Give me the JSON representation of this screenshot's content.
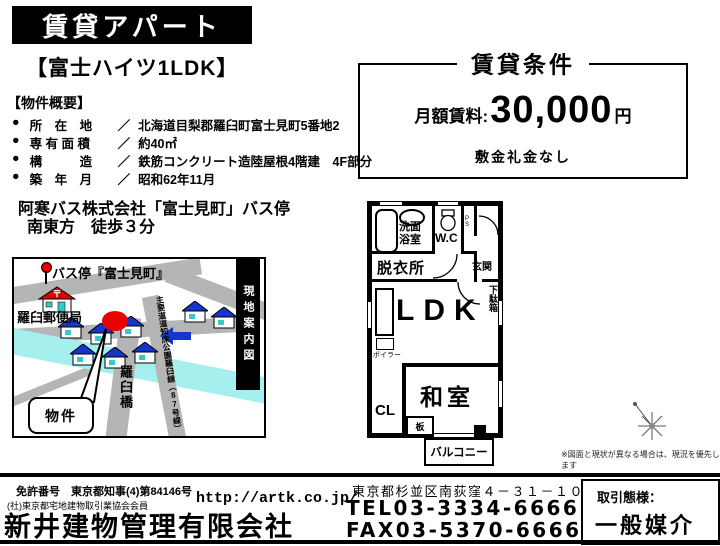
{
  "banner": {
    "title": "賃貸アパート"
  },
  "listing": {
    "name": "【富士ハイツ1LDK】",
    "overview_heading": "【物件概要】",
    "bullet": "●",
    "sep": "／",
    "overview": [
      {
        "label": "所　在　地",
        "value": "北海道目梨郡羅臼町富士見町5番地2"
      },
      {
        "label": "専 有 面 積",
        "value": "約40㎡"
      },
      {
        "label": "構　　　造",
        "value": "鉄筋コンクリート造陸屋根4階建　4F部分"
      },
      {
        "label": "築　年　月",
        "value": "昭和62年11月"
      }
    ],
    "access_line1": "阿寒バス株式会社「富士見町」バス停",
    "access_line2": "南東方　徒歩３分"
  },
  "terms": {
    "title": "賃貸条件",
    "rent_label": "月額賃料:",
    "rent_value": "30,000",
    "rent_unit": "円",
    "note": "敷金礼金なし"
  },
  "map": {
    "bus_stop": "バス停『富士見町』",
    "post_office": "羅臼郵便局",
    "bridge": "羅臼橋",
    "road": "主要道道知床公園羅臼線（87号線）",
    "side_label": "現地案内図",
    "callout": "物件"
  },
  "floorplan": {
    "bath_line1": "洗面",
    "bath_line2": "浴室",
    "wc": "W.C",
    "ps": "PS",
    "entrance": "玄関",
    "dressing": "脱衣所",
    "shoe_cabinet": "下駄箱",
    "ldk": "LDK",
    "boiler": "ボイラー",
    "japanese_room": "和室",
    "closet": "CL",
    "board": "板",
    "balcony": "バルコニー",
    "disclaimer": "※図面と現状が異なる場合は、現況を優先します"
  },
  "footer": {
    "license": "免許番号　東京都知事(4)第84146号",
    "association": "(社)東京都宅地建物取引業協会会員",
    "company": "新井建物管理有限会社",
    "url": "http://artk.co.jp/",
    "address": "東京都杉並区南荻窪４－３１－１０",
    "tel": "TEL03-3334-6666",
    "fax": "FAX03-5370-6666",
    "deal_label": "取引態様：",
    "deal_type": "一般媒介"
  },
  "colors": {
    "accent_red": "#e60000",
    "roof_blue": "#1536c9",
    "river_cyan": "#a5efef",
    "road_gray": "#b5b5b5"
  }
}
